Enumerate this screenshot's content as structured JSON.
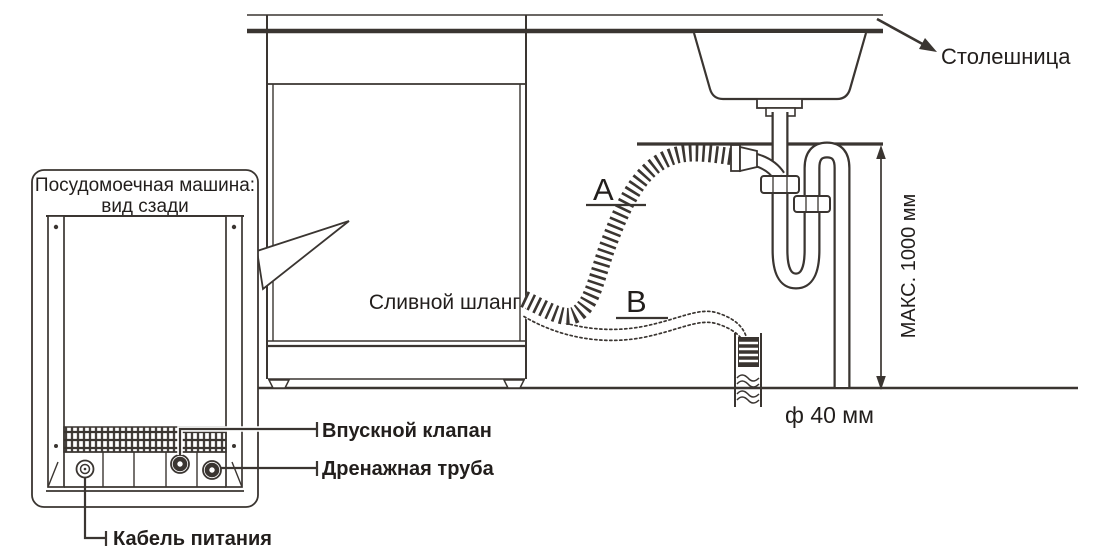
{
  "diagram_title_implicit": "Dishwasher drain hose installation diagram",
  "labels": {
    "countertop": "Столешница",
    "rear_view_title_line1": "Посудомоечная машина:",
    "rear_view_title_line2": "вид сзади",
    "drain_hose": "Сливной шланг",
    "route_a": "A",
    "route_b": "B",
    "max_height": "МАКС. 1000 мм",
    "pipe_diameter": "ф 40 мм",
    "inlet_valve": "Впускной клапан",
    "drain_pipe": "Дренажная труба",
    "power_cable": "Кабель питания"
  },
  "colors": {
    "line": "#3a3531",
    "text": "#221e1c",
    "background": "#ffffff"
  }
}
